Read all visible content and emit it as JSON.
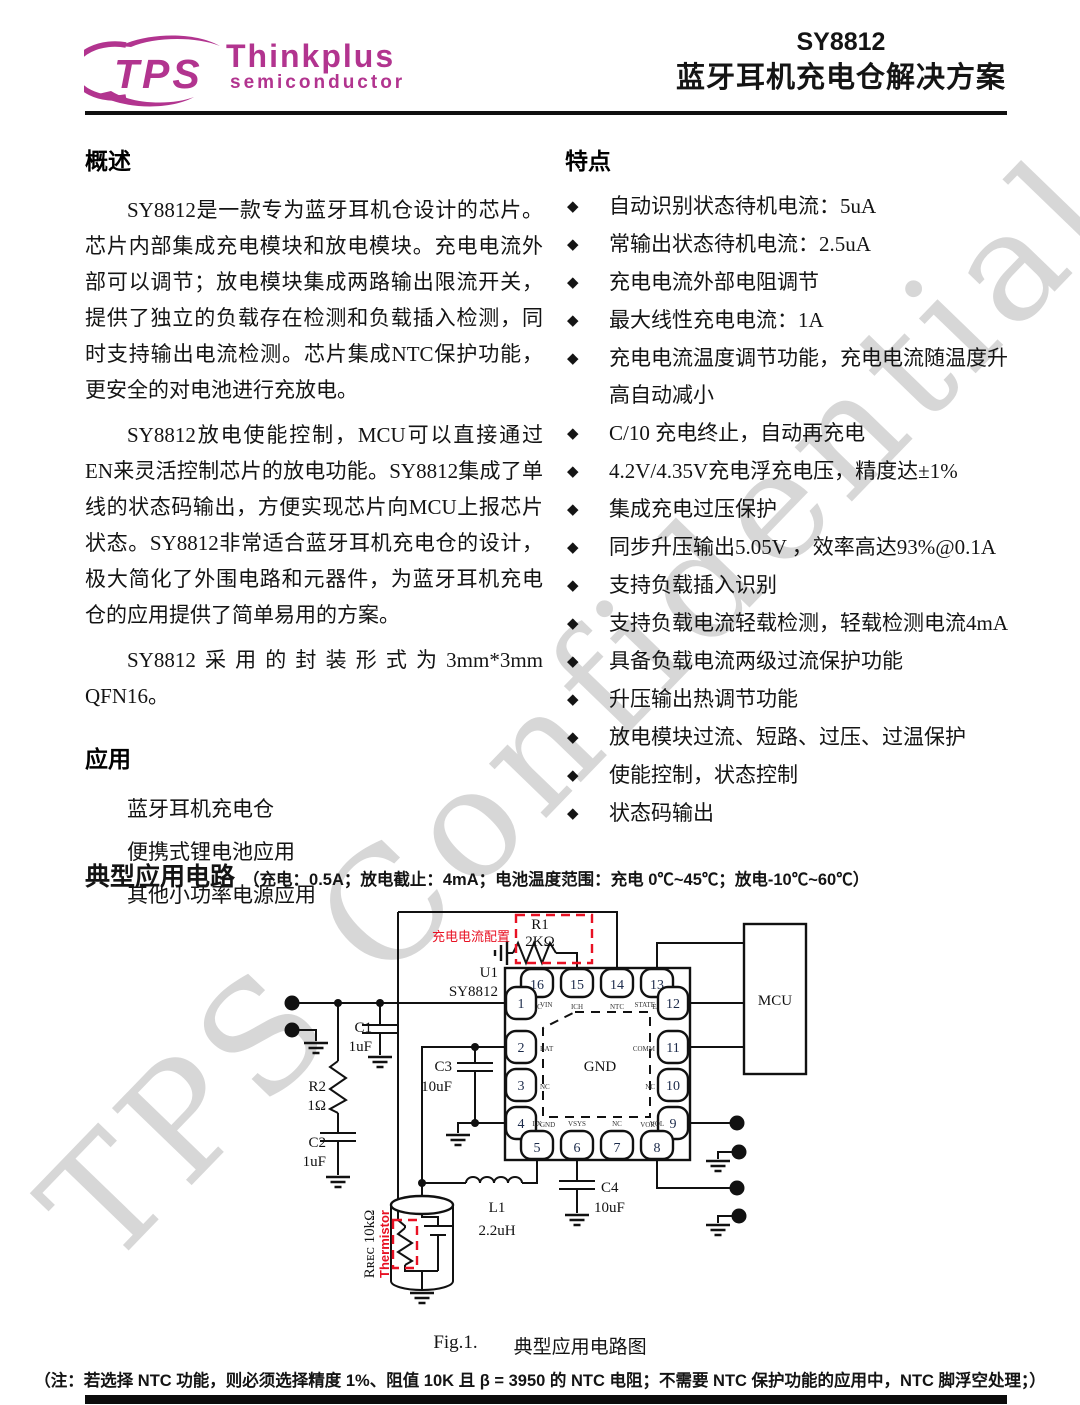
{
  "header": {
    "logo_text": "TPS",
    "brand": "Thinkplus",
    "brand_sub": "semiconductor",
    "part": "SY8812",
    "title": "蓝牙耳机充电仓解决方案"
  },
  "watermark": "TPS Confidential",
  "overview": {
    "heading": "概述",
    "p1": "SY8812是一款专为蓝牙耳机仓设计的芯片。芯片内部集成充电模块和放电模块。充电电流外部可以调节；放电模块集成两路输出限流开关，提供了独立的负载存在检测和负载插入检测，同时支持输出电流检测。芯片集成NTC保护功能，更安全的对电池进行充放电。",
    "p2": "SY8812放电使能控制，MCU可以直接通过EN来灵活控制芯片的放电功能。SY8812集成了单线的状态码输出，方便实现芯片向MCU上报芯片状态。SY8812非常适合蓝牙耳机充电仓的设计，极大简化了外围电路和元器件，为蓝牙耳机充电仓的应用提供了简单易用的方案。",
    "p3": "SY8812采用的封装形式为3mm*3mm QFN16。"
  },
  "features": {
    "heading": "特点",
    "bullet": "◆",
    "items": [
      "自动识别状态待机电流：5uA",
      "常输出状态待机电流：2.5uA",
      "充电电流外部电阻调节",
      "最大线性充电电流：1A",
      "充电电流温度调节功能，充电电流随温度升高自动减小",
      "C/10 充电终止，自动再充电",
      "4.2V/4.35V充电浮充电压，精度达±1%",
      "集成充电过压保护",
      "同步升压输出5.05V ，效率高达93%@0.1A",
      "支持负载插入识别",
      "支持负载电流轻载检测，轻载检测电流4mA",
      "具备负载电流两级过流保护功能",
      "升压输出热调节功能",
      "放电模块过流、短路、过压、过温保护",
      "使能控制，状态控制",
      "状态码输出"
    ]
  },
  "applications": {
    "heading": "应用",
    "items": [
      "蓝牙耳机充电仓",
      "便携式锂电池应用",
      "其他小功率电源应用"
    ]
  },
  "circuit": {
    "heading": "典型应用电路",
    "conditions": "（充电：0.5A；放电截止：4mA；电池温度范围：充电 0℃~45℃；放电-10℃~60℃）",
    "ref_u1": "U1",
    "part": "SY8812",
    "pad": "GND",
    "mcu": "MCU",
    "annotation_red": "充电电流配置",
    "thermistor_label": "Thermistor",
    "thermistor_r": "Rʀᴇᴄ 10kΩ",
    "r1": "R1",
    "r1_v": "2KΩ",
    "r2": "R2",
    "r2_v": "1Ω",
    "c1": "C1",
    "c1_v": "1uF",
    "c2": "C2",
    "c2_v": "1uF",
    "c3": "C3",
    "c3_v": "10uF",
    "c4": "C4",
    "c4_v": "10uF",
    "l1": "L1",
    "l1_v": "2.2uH",
    "pins": {
      "top": [
        {
          "n": "16",
          "name": "NC"
        },
        {
          "n": "15",
          "name": "ICH"
        },
        {
          "n": "14",
          "name": "NTC"
        },
        {
          "n": "13",
          "name": "EN"
        }
      ],
      "left": [
        {
          "n": "1",
          "name": "VIN"
        },
        {
          "n": "2",
          "name": "BAT"
        },
        {
          "n": "3",
          "name": "NC"
        },
        {
          "n": "4",
          "name": "GND"
        }
      ],
      "right": [
        {
          "n": "12",
          "name": "STATE"
        },
        {
          "n": "11",
          "name": "COMM"
        },
        {
          "n": "10",
          "name": "NC"
        },
        {
          "n": "9",
          "name": "VOR"
        }
      ],
      "bottom": [
        {
          "n": "5",
          "name": "LX"
        },
        {
          "n": "6",
          "name": "VSYS"
        },
        {
          "n": "7",
          "name": "NC"
        },
        {
          "n": "8",
          "name": "VOL"
        }
      ]
    },
    "caption_fig": "Fig.1.",
    "caption": "典型应用电路图"
  },
  "note": "（注：若选择 NTC 功能，则必须选择精度 1%、阻值 10K 且 β = 3950 的 NTC 电阻；不需要 NTC 保护功能的应用中，NTC 脚浮空处理；）",
  "colors": {
    "brand": "#b2348f",
    "annotation_red": "#e81123",
    "watermark": "#d7d7d7"
  }
}
